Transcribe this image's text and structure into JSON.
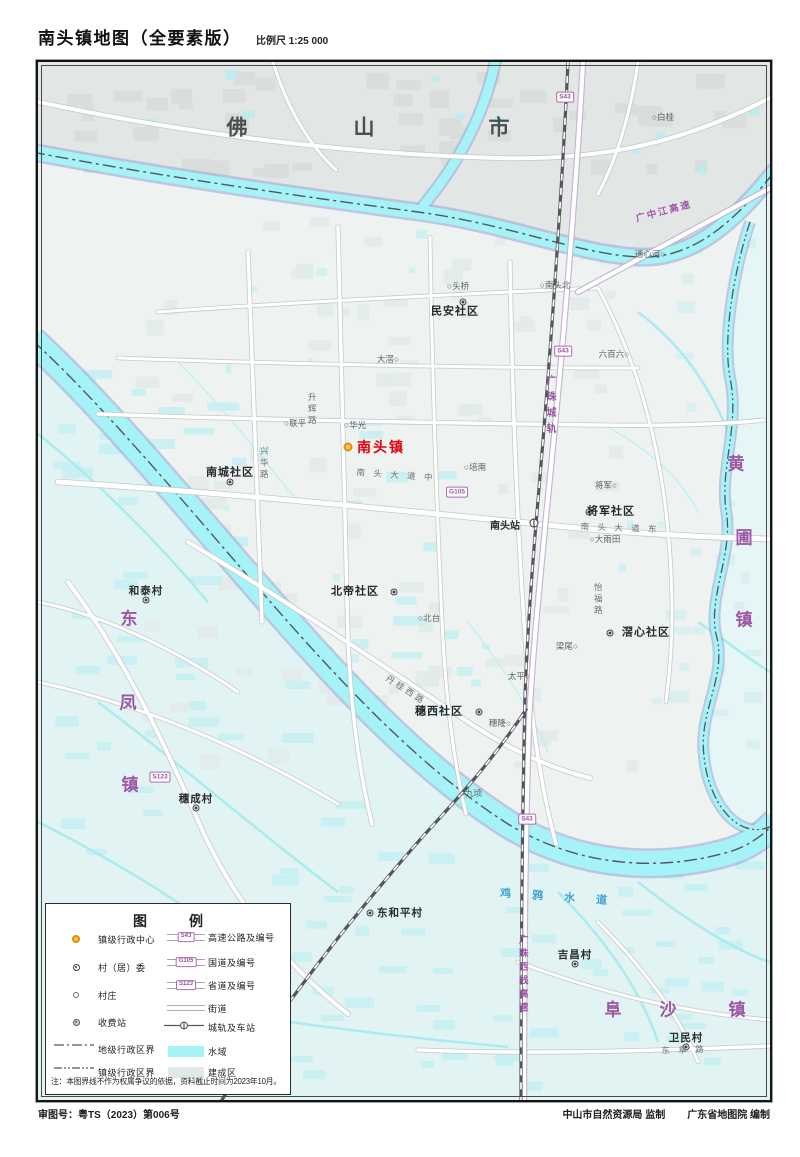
{
  "header": {
    "title": "南头镇地图（全要素版）",
    "scale": "比例尺 1:25 000"
  },
  "footer": {
    "approval": "审图号：粤TS（2023）第006号",
    "producer": "中山市自然资源局 监制",
    "compiler": "广东省地图院 编制"
  },
  "colors": {
    "water": "#a5f2f7",
    "builtup": "#dfe9e7",
    "accent_red": "#e8000d",
    "town_purple": "#9d57a5",
    "marker_orange": "#fbc14d"
  },
  "legend": {
    "title": "图　例",
    "left": [
      {
        "sym": "town-center",
        "label": "镇级行政中心"
      },
      {
        "sym": "committee",
        "label": "村（居）委"
      },
      {
        "sym": "hamlet",
        "label": "村庄"
      },
      {
        "sym": "toll",
        "label": "收费站"
      },
      {
        "sym": "city-boundary",
        "label": "地级行政区界"
      },
      {
        "sym": "town-boundary",
        "label": "镇级行政区界"
      }
    ],
    "right": [
      {
        "sym": "expressway",
        "badge": "S43",
        "label": "高速公路及编号"
      },
      {
        "sym": "national-road",
        "badge": "G105",
        "label": "国道及编号"
      },
      {
        "sym": "provincial-road",
        "badge": "S123",
        "label": "省道及编号"
      },
      {
        "sym": "street",
        "label": "街道"
      },
      {
        "sym": "rail",
        "label": "城轨及车站"
      },
      {
        "sym": "water",
        "label": "水域"
      },
      {
        "sym": "builtup",
        "label": "建成区"
      }
    ],
    "note": "注：本图界线不作为权属争议的依据，资料截止时间为2023年10月。"
  },
  "map": {
    "labels": [
      {
        "name": "city-foshan-char1",
        "text": "佛",
        "x": 200,
        "y": 66,
        "cls": "city"
      },
      {
        "name": "city-foshan-char2",
        "text": "山",
        "x": 327,
        "y": 66,
        "cls": "city"
      },
      {
        "name": "city-foshan-char3",
        "text": "市",
        "x": 462,
        "y": 66,
        "cls": "city"
      },
      {
        "name": "town-huangpu-char1",
        "text": "黄",
        "x": 698,
        "y": 402,
        "cls": "town"
      },
      {
        "name": "town-huangpu-char2",
        "text": "圃",
        "x": 706,
        "y": 476,
        "cls": "town"
      },
      {
        "name": "town-huangpu-char3",
        "text": "镇",
        "x": 706,
        "y": 558,
        "cls": "town"
      },
      {
        "name": "town-dongfeng-char1",
        "text": "东",
        "x": 91,
        "y": 557,
        "cls": "town"
      },
      {
        "name": "town-dongfeng-char2",
        "text": "凤",
        "x": 90,
        "y": 641,
        "cls": "town"
      },
      {
        "name": "town-dongfeng-char3",
        "text": "镇",
        "x": 92,
        "y": 723,
        "cls": "town"
      },
      {
        "name": "town-fusha-char1",
        "text": "阜",
        "x": 575,
        "y": 948,
        "cls": "town"
      },
      {
        "name": "town-fusha-char2",
        "text": "沙",
        "x": 630,
        "y": 948,
        "cls": "town"
      },
      {
        "name": "town-fusha-char3",
        "text": "镇",
        "x": 699,
        "y": 948,
        "cls": "town"
      },
      {
        "name": "town-nantou-label",
        "text": "南头镇",
        "x": 343,
        "y": 385,
        "cls": "head"
      },
      {
        "name": "community-minan",
        "text": "民安社区",
        "x": 417,
        "y": 250,
        "cls": "com"
      },
      {
        "name": "community-nancheng",
        "text": "南城社区",
        "x": 192,
        "y": 411,
        "cls": "com"
      },
      {
        "name": "community-jiangjun",
        "text": "将军社区",
        "x": 573,
        "y": 450,
        "cls": "com"
      },
      {
        "name": "community-beidi",
        "text": "北帝社区",
        "x": 317,
        "y": 530,
        "cls": "com"
      },
      {
        "name": "community-suixi",
        "text": "穗西社区",
        "x": 401,
        "y": 650,
        "cls": "com"
      },
      {
        "name": "community-jiaoxin",
        "text": "滘心社区",
        "x": 608,
        "y": 571,
        "cls": "com"
      },
      {
        "name": "village-hetai",
        "text": "和泰村",
        "x": 108,
        "y": 529,
        "cls": "vil"
      },
      {
        "name": "village-suicheng",
        "text": "穗成村",
        "x": 158,
        "y": 737,
        "cls": "vil"
      },
      {
        "name": "village-dongheping",
        "text": "东和平村",
        "x": 362,
        "y": 851,
        "cls": "vil"
      },
      {
        "name": "village-jichang",
        "text": "吉昌村",
        "x": 537,
        "y": 893,
        "cls": "vil"
      },
      {
        "name": "village-weimin",
        "text": "卫民村",
        "x": 648,
        "y": 976,
        "cls": "vil"
      },
      {
        "name": "hamlet-baigui",
        "text": "○白桂",
        "x": 625,
        "y": 55,
        "cls": "ham"
      },
      {
        "name": "hamlet-touqiao",
        "text": "○头桥",
        "x": 420,
        "y": 224,
        "cls": "ham"
      },
      {
        "name": "hamlet-nantoubei",
        "text": "○南头北",
        "x": 517,
        "y": 223,
        "cls": "ham"
      },
      {
        "name": "hamlet-tongxinhe",
        "text": "通心河○",
        "x": 612,
        "y": 192,
        "cls": "ham"
      },
      {
        "name": "hamlet-liubailiu",
        "text": "六百六○",
        "x": 576,
        "y": 292,
        "cls": "ham"
      },
      {
        "name": "hamlet-lianping",
        "text": "○联平",
        "x": 257,
        "y": 361,
        "cls": "ham"
      },
      {
        "name": "hamlet-huaguang",
        "text": "○华光",
        "x": 317,
        "y": 363,
        "cls": "ham"
      },
      {
        "name": "hamlet-dajiao",
        "text": "大滘○",
        "x": 350,
        "y": 297,
        "cls": "ham"
      },
      {
        "name": "hamlet-peinan",
        "text": "○培南",
        "x": 437,
        "y": 405,
        "cls": "ham"
      },
      {
        "name": "hamlet-jiangjun",
        "text": "将军○",
        "x": 568,
        "y": 423,
        "cls": "ham"
      },
      {
        "name": "hamlet-dayutian",
        "text": "○大雨田",
        "x": 567,
        "y": 477,
        "cls": "ham"
      },
      {
        "name": "hamlet-beitai",
        "text": "○北台",
        "x": 391,
        "y": 556,
        "cls": "ham"
      },
      {
        "name": "hamlet-taiping",
        "text": "太平○",
        "x": 481,
        "y": 614,
        "cls": "ham"
      },
      {
        "name": "hamlet-suilong",
        "text": "穗隆○",
        "x": 462,
        "y": 661,
        "cls": "ham"
      },
      {
        "name": "hamlet-jiuqing",
        "text": "○九顷",
        "x": 433,
        "y": 731,
        "cls": "ham"
      },
      {
        "name": "hamlet-liangwei",
        "text": "梁尾○",
        "x": 529,
        "y": 584,
        "cls": "ham"
      },
      {
        "name": "station-nantou",
        "text": "南头站",
        "x": 467,
        "y": 465,
        "cls": "sta"
      },
      {
        "name": "roadname-nantoudadao-zhong",
        "text": "南 头 大 道 中",
        "x": 358,
        "y": 413,
        "cls": "road",
        "rot": 4
      },
      {
        "name": "roadname-nantoudadao-dong",
        "text": "南 头 大 道 东",
        "x": 582,
        "y": 466,
        "cls": "road",
        "rot": 2
      },
      {
        "name": "roadname-dongfulu",
        "text": "东 阜 路",
        "x": 646,
        "y": 988,
        "cls": "road",
        "rot": -2
      },
      {
        "name": "roadname-xinghualu",
        "text": "兴华路",
        "x": 226,
        "y": 402,
        "cls": "roadv"
      },
      {
        "name": "roadname-shenghuilu",
        "text": "升辉路",
        "x": 274,
        "y": 348,
        "cls": "roadv"
      },
      {
        "name": "roadname-yifulu",
        "text": "怡福路",
        "x": 560,
        "y": 538,
        "cls": "roadv"
      },
      {
        "name": "roadname-danguixilu",
        "text": "丹桂西路",
        "x": 368,
        "y": 628,
        "cls": "road",
        "rot": 33
      },
      {
        "name": "railname-guangzhuchenggui",
        "text": "广珠城轨",
        "x": 511,
        "y": 345,
        "cls": "railv"
      },
      {
        "name": "expwyname-guangzhongjiang",
        "text": "广中江高速",
        "x": 626,
        "y": 150,
        "cls": "exp",
        "rot": -15
      },
      {
        "name": "expwyname-guangzhuxixian",
        "text": "广珠西线高速",
        "x": 484,
        "y": 913,
        "cls": "expv"
      },
      {
        "name": "rivername-jiyashuidao",
        "text": "鸡 鸦 水 道",
        "x": 520,
        "y": 836,
        "cls": "riv",
        "rot": 4
      }
    ],
    "badges": [
      {
        "text": "S43",
        "x": 527,
        "y": 35
      },
      {
        "text": "S43",
        "x": 525,
        "y": 289
      },
      {
        "text": "G105",
        "x": 419,
        "y": 430
      },
      {
        "text": "S123",
        "x": 122,
        "y": 715
      },
      {
        "text": "S43",
        "x": 489,
        "y": 757
      }
    ],
    "markers": [
      {
        "type": "tc",
        "name": "marker-town-center-nantou",
        "x": 310,
        "y": 385
      },
      {
        "type": "cm",
        "name": "marker-committee-nancheng",
        "x": 192,
        "y": 420
      },
      {
        "type": "cm",
        "name": "marker-committee-minan",
        "x": 425,
        "y": 240
      },
      {
        "type": "cm",
        "name": "marker-committee-jiangjun",
        "x": 551,
        "y": 450
      },
      {
        "type": "cm",
        "name": "marker-committee-beidi",
        "x": 356,
        "y": 530
      },
      {
        "type": "cm",
        "name": "marker-committee-suixi",
        "x": 441,
        "y": 650
      },
      {
        "type": "cm",
        "name": "marker-committee-jiaoxin",
        "x": 572,
        "y": 571
      },
      {
        "type": "cm",
        "name": "marker-committee-hetai",
        "x": 108,
        "y": 538
      },
      {
        "type": "cm",
        "name": "marker-committee-suicheng",
        "x": 158,
        "y": 746
      },
      {
        "type": "cm",
        "name": "marker-committee-dongheping",
        "x": 332,
        "y": 851
      },
      {
        "type": "cm",
        "name": "marker-committee-jichang",
        "x": 537,
        "y": 902
      },
      {
        "type": "cm",
        "name": "marker-committee-weimin",
        "x": 648,
        "y": 985
      },
      {
        "type": "st",
        "name": "marker-station-nantou",
        "x": 496,
        "y": 461
      }
    ]
  }
}
